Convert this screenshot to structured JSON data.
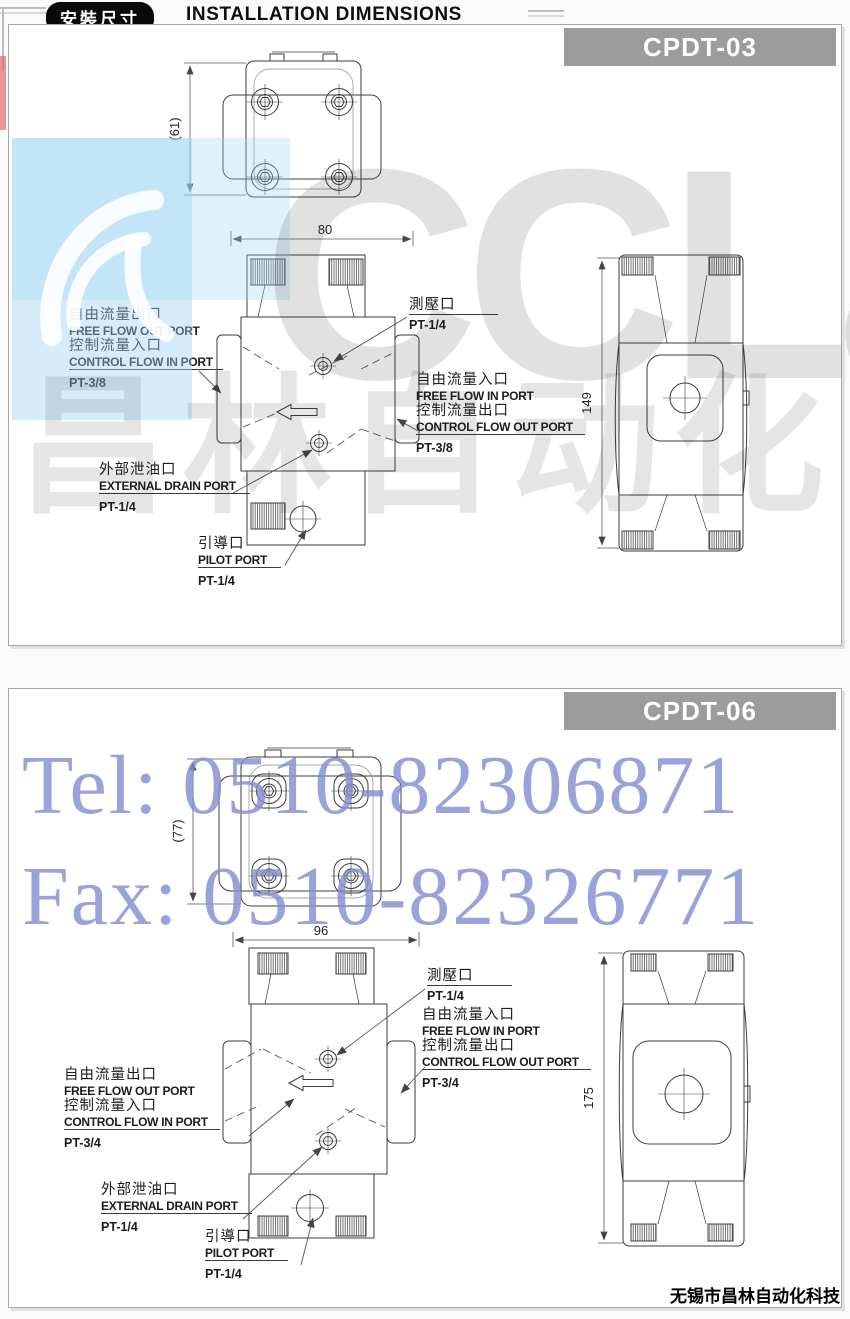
{
  "header": {
    "badge_cn": "安裝尺寸",
    "title_en": "INSTALLATION DIMENSIONS"
  },
  "watermarks": {
    "brand_latin": "CCLair",
    "brand_cn": "昌林自动化",
    "tel_line": "Tel: 0510-82306871",
    "fax_line": "Fax: 0510-82326771"
  },
  "page": {
    "footer_company": "无锡市昌林自动化科技"
  },
  "colors": {
    "banner_bg": "#9c9c9c",
    "header_badge_bg": "#0a0a0a",
    "watermark_blue": "#9ed2f3",
    "watermark_contact_text": "#808fd2",
    "watermark_gray": "#d9d9d9"
  },
  "panels": [
    {
      "model": "CPDT-03",
      "dims": {
        "top_view_height": "(61)",
        "body_width": "80",
        "body_height": "149"
      },
      "ports": {
        "free_out_cn": "自由流量出口",
        "free_out_en": "FREE FLOW OUT PORT",
        "ctrl_in_cn": "控制流量入口",
        "ctrl_in_en": "CONTROL FLOW IN PORT",
        "ctrl_in_size": "PT-3/8",
        "gauge_cn": "測壓口",
        "gauge_size": "PT-1/4",
        "free_in_cn": "自由流量入口",
        "free_in_en": "FREE FLOW IN PORT",
        "ctrl_out_cn": "控制流量出口",
        "ctrl_out_en": "CONTROL FLOW OUT PORT",
        "ctrl_out_size": "PT-3/8",
        "drain_cn": "外部泄油口",
        "drain_en": "EXTERNAL DRAIN PORT",
        "drain_size": "PT-1/4",
        "pilot_cn": "引導口",
        "pilot_en": "PILOT PORT",
        "pilot_size": "PT-1/4"
      }
    },
    {
      "model": "CPDT-06",
      "dims": {
        "top_view_height": "(77)",
        "body_width": "96",
        "body_height": "175"
      },
      "ports": {
        "free_out_cn": "自由流量出口",
        "free_out_en": "FREE FLOW OUT PORT",
        "ctrl_in_cn": "控制流量入口",
        "ctrl_in_en": "CONTROL FLOW IN PORT",
        "ctrl_in_size": "PT-3/4",
        "gauge_cn": "測壓口",
        "gauge_size": "PT-1/4",
        "free_in_cn": "自由流量入口",
        "free_in_en": "FREE FLOW IN PORT",
        "ctrl_out_cn": "控制流量出口",
        "ctrl_out_en": "CONTROL FLOW OUT PORT",
        "ctrl_out_size": "PT-3/4",
        "drain_cn": "外部泄油口",
        "drain_en": "EXTERNAL DRAIN PORT",
        "drain_size": "PT-1/4",
        "pilot_cn": "引導口",
        "pilot_en": "PILOT PORT",
        "pilot_size": "PT-1/4"
      }
    }
  ]
}
